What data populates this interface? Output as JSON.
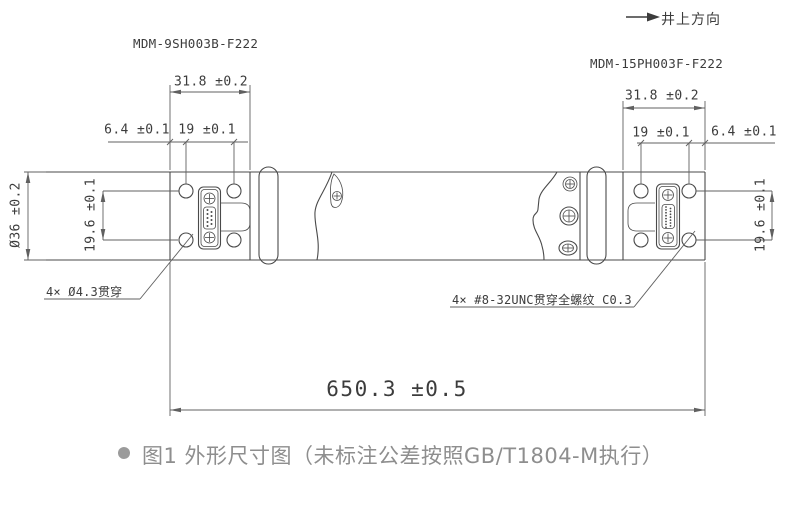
{
  "drawing": {
    "uphole_label": "井上方向",
    "left_part_number": "MDM-9SH003B-F222",
    "right_part_number": "MDM-15PH003F-F222",
    "dims": {
      "left_block_width": "31.8 ±0.2",
      "left_hole_edge_offset": "6.4 ±0.1",
      "left_hole_pitch": "19 ±0.1",
      "body_diameter": "Ø36 ±0.2",
      "left_hole_row_pitch": "19.6 ±0.1",
      "right_block_width": "31.8 ±0.2",
      "right_hole_pitch": "19 ±0.1",
      "right_hole_edge_offset": "6.4 ±0.1",
      "right_hole_row_pitch": "19.6 ±0.1",
      "overall_length": "650.3 ±0.5"
    },
    "callouts": {
      "left_holes": "4× Ø4.3贯穿",
      "right_holes": "4× #8-32UNC贯穿全螺纹 C0.3"
    }
  },
  "caption": {
    "figure_text": "图1 外形尺寸图（未标注公差按照GB/T1804-M执行）"
  },
  "colors": {
    "line": "#4a4a4a",
    "dim_line": "#606060",
    "text": "#3c3c3c",
    "caption_text": "#8e8e8e",
    "caption_bullet": "#9b9b9b"
  }
}
